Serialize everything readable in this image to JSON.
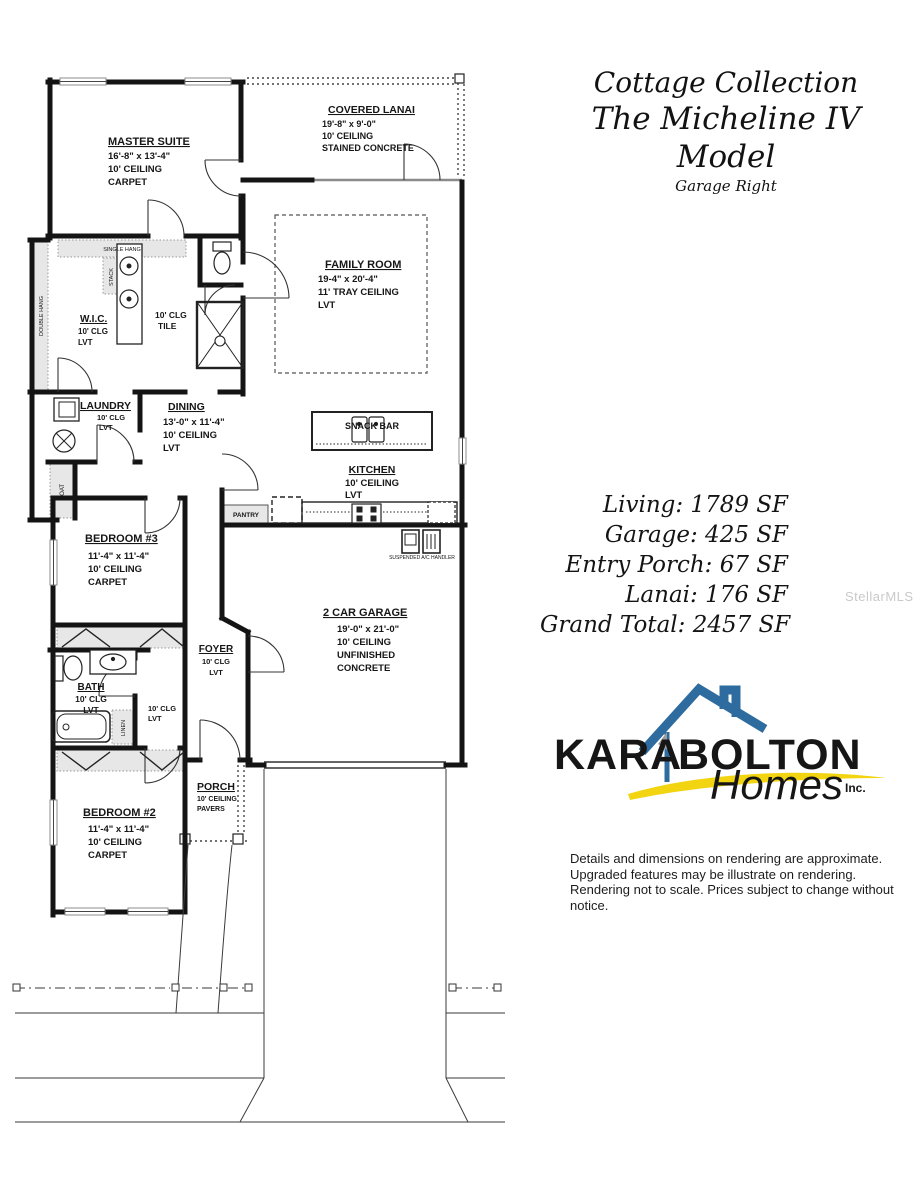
{
  "title": {
    "collection": "Cottage Collection",
    "model": "The Micheline IV Model",
    "variant": "Garage Right"
  },
  "areas": {
    "living": "Living: 1789 SF",
    "garage": "Garage: 425 SF",
    "entry_porch": "Entry Porch: 67 SF",
    "lanai": "Lanai: 176 SF",
    "grand_total": "Grand Total: 2457 SF"
  },
  "rooms": {
    "master_suite": {
      "name": "MASTER SUITE",
      "dims": "16'-8\" x 13'-4\"",
      "ceiling": "10' CEILING",
      "floor": "CARPET"
    },
    "covered_lanai": {
      "name": "COVERED LANAI",
      "dims": "19'-8\" x 9'-0\"",
      "ceiling": "10' CEILING",
      "floor": "STAINED CONCRETE"
    },
    "family_room": {
      "name": "FAMILY ROOM",
      "dims": "19-4\" x 20'-4\"",
      "ceiling": "11' TRAY CEILING",
      "floor": "LVT"
    },
    "wic": {
      "name": "W.I.C.",
      "ceiling": "10' CLG",
      "floor": "LVT"
    },
    "master_bath": {
      "ceiling": "10' CLG",
      "floor": "TILE"
    },
    "laundry": {
      "name": "LAUNDRY",
      "ceiling": "10' CLG",
      "floor": "LVT"
    },
    "dining": {
      "name": "DINING",
      "dims": "13'-0\" x 11'-4\"",
      "ceiling": "10' CEILING",
      "floor": "LVT"
    },
    "snack_bar": {
      "name": "SNACK BAR"
    },
    "kitchen": {
      "name": "KITCHEN",
      "ceiling": "10' CEILING",
      "floor": "LVT"
    },
    "bedroom3": {
      "name": "BEDROOM #3",
      "dims": "11'-4\" x 11'-4\"",
      "ceiling": "10' CEILING",
      "floor": "CARPET"
    },
    "garage": {
      "name": "2 CAR GARAGE",
      "dims": "19'-0\" x 21'-0\"",
      "ceiling": "10' CEILING",
      "floor1": "UNFINISHED",
      "floor2": "CONCRETE"
    },
    "foyer": {
      "name": "FOYER",
      "ceiling": "10' CLG",
      "floor": "LVT"
    },
    "hall": {
      "ceiling": "10' CLG",
      "floor": "LVT"
    },
    "bath": {
      "name": "BATH",
      "ceiling": "10' CLG",
      "floor": "LVT"
    },
    "bedroom2": {
      "name": "BEDROOM #2",
      "dims": "11'-4\" x 11'-4\"",
      "ceiling": "10' CEILING",
      "floor": "CARPET"
    },
    "porch": {
      "name": "PORCH",
      "ceiling": "10' CEILING",
      "floor": "PAVERS"
    }
  },
  "labels": {
    "single_hang": "SINGLE HANG",
    "double_hang": "DOUBLE HANG",
    "stack": "STACK",
    "coat": "COAT",
    "linen": "LINEN",
    "pantry": "PANTRY",
    "ac": "SUSPENDED A/C HANDLER"
  },
  "logo": {
    "kara": "KARA",
    "bolton": "BOLTON",
    "homes": "Homes",
    "inc": "Inc."
  },
  "disclaimer": {
    "line1": "Details and dimensions on rendering are approximate.",
    "line2": "Upgraded features may be illustrate on rendering.",
    "line3": "Rendering not to scale.  Prices subject to change without notice."
  },
  "watermark": "StellarMLS",
  "colors": {
    "wall": "#141414",
    "logo_blue": "#2e6b9e",
    "logo_gray": "#9b9b9b",
    "logo_yellow": "#f2d411"
  }
}
